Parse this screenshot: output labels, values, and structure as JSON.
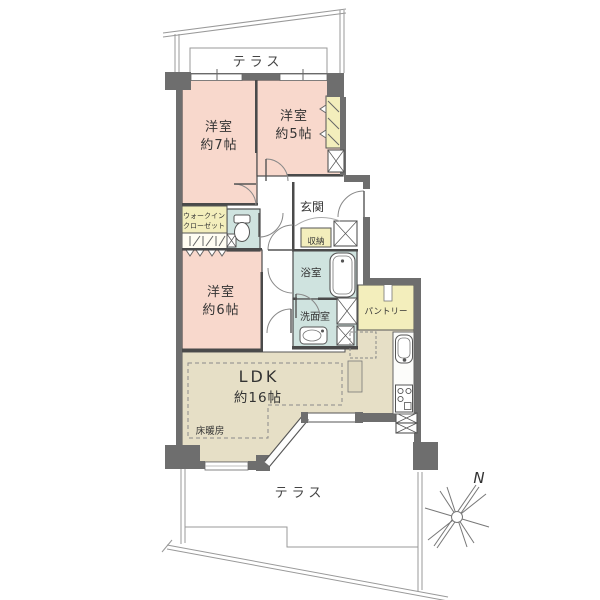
{
  "colors": {
    "bedroom": "#f8d8cc",
    "service": "#f3eebc",
    "wet": "#cfe3df",
    "ldk": "#e6dfc6",
    "wall": "#6e6e6e"
  },
  "rooms": {
    "bedroom7": {
      "name": "洋室",
      "size": "約7帖"
    },
    "bedroom5": {
      "name": "洋室",
      "size": "約5帖"
    },
    "bedroom6": {
      "name": "洋室",
      "size": "約6帖"
    },
    "ldk": {
      "name": "LDK",
      "size": "約16帖"
    },
    "entrance": {
      "label": "玄関"
    },
    "bathroom": {
      "label": "浴室"
    },
    "washroom": {
      "label": "洗面室"
    },
    "walk_in_closet": {
      "line1": "ウォークイン",
      "line2": "クローゼット"
    },
    "storage": {
      "label": "収納"
    },
    "pantry": {
      "label": "パントリー"
    },
    "floor_heating": {
      "label": "床暖房"
    }
  },
  "outdoor": {
    "terrace_top": "テラス",
    "terrace_bottom": "テラス"
  },
  "compass": {
    "north": "N"
  }
}
